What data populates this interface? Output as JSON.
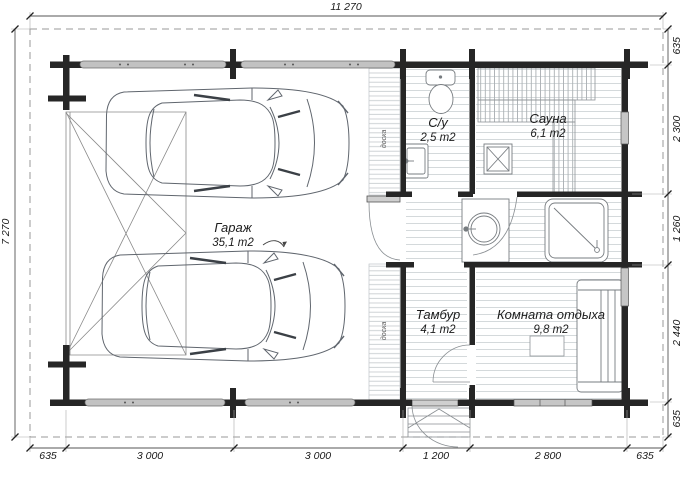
{
  "drawing": {
    "dims": {
      "top": "11 270",
      "left": "7 270",
      "right": [
        "635",
        "2 300",
        "1 260",
        "2 440",
        "635"
      ],
      "bottom": [
        "635",
        "3 000",
        "3 000",
        "1 200",
        "2 800",
        "635"
      ]
    },
    "rooms": {
      "garage": {
        "name": "Гараж",
        "area": "35,1 m2"
      },
      "wc": {
        "name": "С/у",
        "area": "2,5 m2"
      },
      "sauna": {
        "name": "Сауна",
        "area": "6,1 m2"
      },
      "vestibule": {
        "name": "Тамбур",
        "area": "4,1 m2"
      },
      "lounge": {
        "name": "Комната отдыха",
        "area": "9,8 m2"
      }
    },
    "notes": {
      "plank": "доска"
    },
    "colors": {
      "wall": "#262626",
      "log": "#c2c2c2",
      "dash": "#9a9a9a"
    }
  }
}
